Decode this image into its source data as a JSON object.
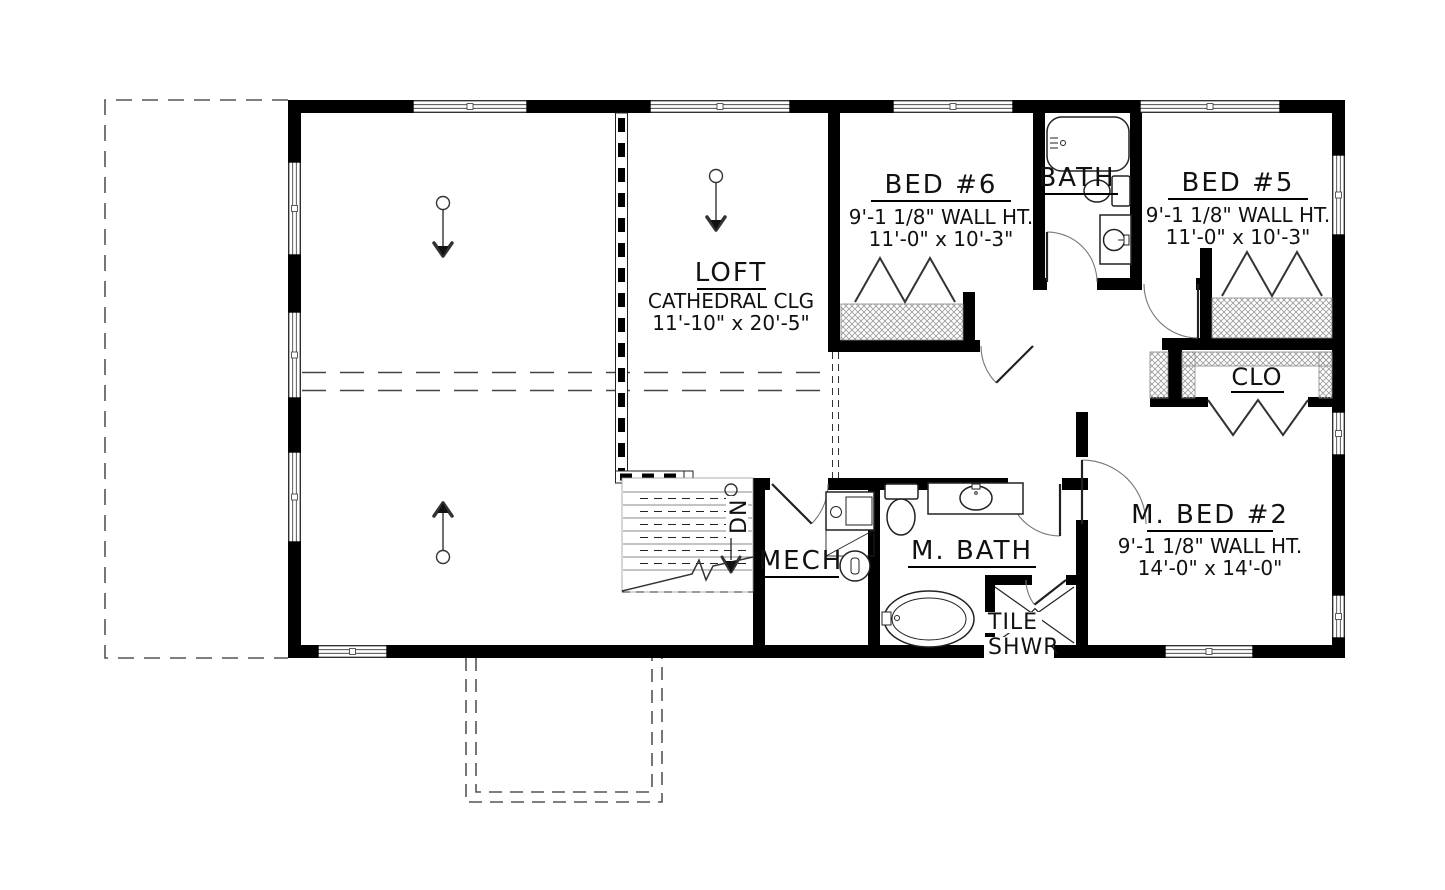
{
  "plan_type": "floor-plan",
  "rooms": {
    "loft": {
      "name": "LOFT",
      "note": "CATHEDRAL CLG",
      "dims": "11'-10\" x 20'-5\""
    },
    "bed6": {
      "name": "BED #6",
      "wall_ht": "9'-1 1/8\" WALL HT.",
      "dims": "11'-0\" x 10'-3\""
    },
    "bath": {
      "name": "BATH"
    },
    "bed5": {
      "name": "BED #5",
      "wall_ht": "9'-1 1/8\" WALL HT.",
      "dims": "11'-0\" x 10'-3\""
    },
    "closet": {
      "name": "CLO"
    },
    "mech": {
      "name": "MECH"
    },
    "master_bath": {
      "name": "M. BATH"
    },
    "master_bed": {
      "name": "M. BED #2",
      "wall_ht": "9'-1 1/8\" WALL HT.",
      "dims": "14'-0\" x 14'-0\""
    },
    "tile_shower": {
      "line1": "TILE",
      "line2": "SHWR"
    },
    "stairs": {
      "direction": "DN"
    }
  },
  "colors": {
    "walls": "#000000",
    "background": "#ffffff",
    "thin_line": "#333333",
    "hatch": "#999999",
    "dashed_outline": "#555555"
  }
}
